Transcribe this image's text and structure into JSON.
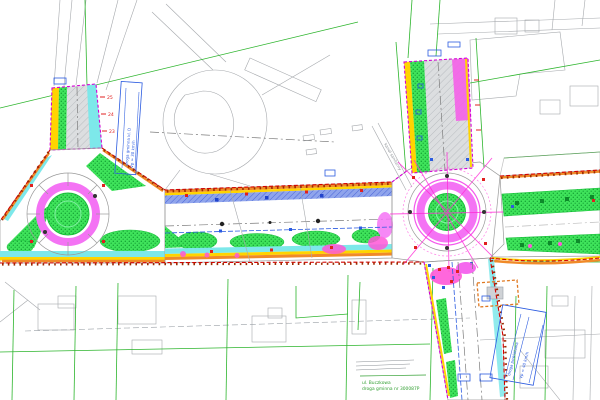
{
  "page": {
    "title": "Road reconstruction site plan with two roundabouts",
    "canvas": {
      "width": 600,
      "height": 400
    }
  },
  "plan": {
    "boundary": {
      "project_limit_color": "#d40000",
      "secondary_limit_color": "#d400d4",
      "edge_band_orange": "#f08a28",
      "curb_yellow": "#ffd400"
    },
    "surfaces": {
      "roadway": {
        "label": "roadway asphalt",
        "color": "#dcdee0"
      },
      "sidewalk": {
        "label": "sidewalk",
        "color": "#8fa4ec"
      },
      "cycle_path": {
        "label": "cycle path",
        "color": "#7de8ea"
      },
      "greenery": {
        "label": "greenery",
        "color": "#3fe35b"
      },
      "truck_apron": {
        "label": "roundabout truck apron",
        "color": "#f473f4"
      },
      "pavement_pink": {
        "label": "paved island",
        "color": "#ff57d8"
      }
    },
    "cadastre": {
      "parcel_line_color": "#2db52d",
      "building_line_color": "#a6a9ad"
    },
    "labels": {
      "station_25": "25",
      "station_24": "24",
      "station_23": "23",
      "left_note_line1": "droga gminna kl. D",
      "left_note_line2": "Vp = 30 km/h",
      "right_note_line1": "droga powiatowa",
      "right_note_line2": "Vp = 40 km/h",
      "street_name": "ul. Buczkowa",
      "street_ref": "droga gminna nr 300087P",
      "utility_note": "kanał sanitarny"
    }
  }
}
